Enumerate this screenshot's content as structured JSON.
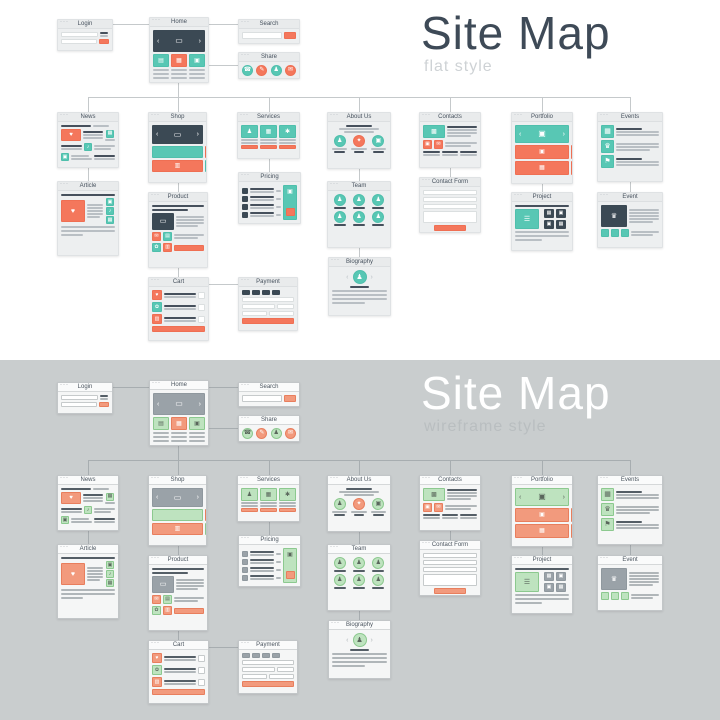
{
  "illustration": {
    "window_dots": "···",
    "halves": [
      {
        "id": "flat",
        "title": "Site Map",
        "subtitle": "flat style",
        "colors": {
          "page_bg": "#ffffff",
          "title": "#3e4a57",
          "subtitle": "#ced2d5",
          "card_bg": "#edeff0",
          "card_border": "#dfe2e4",
          "header_bg": "#e9ebec",
          "header_border": "#dcdfe1",
          "header_text": "#47525e",
          "dots": "#98a0a7",
          "line": "#b9bfc4",
          "line_dark": "#46505c",
          "accent1": "#58c7b4",
          "accent1_border": "#4fbfac",
          "accent2": "#f4775c",
          "accent2_border": "#ef6f53",
          "block": "#3b4954",
          "block_border": "#3b4954",
          "icon_on_accent1": "#ffffff",
          "icon_on_accent2": "#ffffff",
          "icon_on_block": "#ffffff",
          "input_bg": "#ffffff",
          "input_border": "#dbdfe0",
          "connector": "#c5c9cb"
        }
      },
      {
        "id": "wireframe",
        "title": "Site Map",
        "subtitle": "wireframe style",
        "colors": {
          "page_bg": "#c9cdce",
          "title": "#ffffff",
          "subtitle": "#b9bec0",
          "card_bg": "#f5f6f6",
          "card_border": "#c2c6c8",
          "header_bg": "#fafbfb",
          "header_border": "#d5d8d9",
          "header_text": "#4a545e",
          "dots": "#707a82",
          "line": "#b0b6b9",
          "line_dark": "#545e66",
          "accent1": "#bee3bf",
          "accent1_border": "#8cc98f",
          "accent2": "#f29a7d",
          "accent2_border": "#e87e5d",
          "block": "#9aa2a8",
          "block_border": "#8f989e",
          "icon_on_accent1": "#5a675c",
          "icon_on_accent2": "#ffffff",
          "icon_on_block": "#ffffff",
          "input_bg": "#ffffff",
          "input_border": "#c6cacb",
          "connector": "#a7adb0"
        }
      }
    ],
    "nodes": [
      {
        "id": "login",
        "label": "Login",
        "type": "login"
      },
      {
        "id": "home",
        "label": "Home",
        "type": "home"
      },
      {
        "id": "search",
        "label": "Search",
        "type": "search"
      },
      {
        "id": "share",
        "label": "Share",
        "type": "share"
      },
      {
        "id": "news",
        "label": "News",
        "type": "news"
      },
      {
        "id": "shop",
        "label": "Shop",
        "type": "shop"
      },
      {
        "id": "services",
        "label": "Services",
        "type": "services"
      },
      {
        "id": "aboutus",
        "label": "About Us",
        "type": "about"
      },
      {
        "id": "contacts",
        "label": "Contacts",
        "type": "contacts"
      },
      {
        "id": "portfolio",
        "label": "Portfolio",
        "type": "portfolio"
      },
      {
        "id": "events",
        "label": "Events",
        "type": "events"
      },
      {
        "id": "article",
        "label": "Article",
        "type": "article"
      },
      {
        "id": "product",
        "label": "Product",
        "type": "product"
      },
      {
        "id": "pricing",
        "label": "Pricing",
        "type": "pricing"
      },
      {
        "id": "team",
        "label": "Team",
        "type": "team"
      },
      {
        "id": "contactform",
        "label": "Contact Form",
        "type": "form"
      },
      {
        "id": "project",
        "label": "Project",
        "type": "project"
      },
      {
        "id": "event",
        "label": "Event",
        "type": "eventpage"
      },
      {
        "id": "cart",
        "label": "Cart",
        "type": "cart"
      },
      {
        "id": "payment",
        "label": "Payment",
        "type": "payment"
      },
      {
        "id": "biography",
        "label": "Biography",
        "type": "bio"
      }
    ],
    "icons": {
      "chevron-left": "‹",
      "chevron-right": "›",
      "monitor": "▭",
      "grid": "▤",
      "chart": "▦",
      "folder": "▣",
      "image": "▣",
      "user": "♟",
      "phone": "☎",
      "pencil": "✎",
      "mail": "✉",
      "heart": "♥",
      "music": "♪",
      "gift": "✿",
      "cart": "▥",
      "building": "▩",
      "calendar": "▦",
      "trophy": "♛",
      "flag": "⚑",
      "list": "☰",
      "star": "✦",
      "gear": "✱",
      "badge": "♛"
    }
  }
}
